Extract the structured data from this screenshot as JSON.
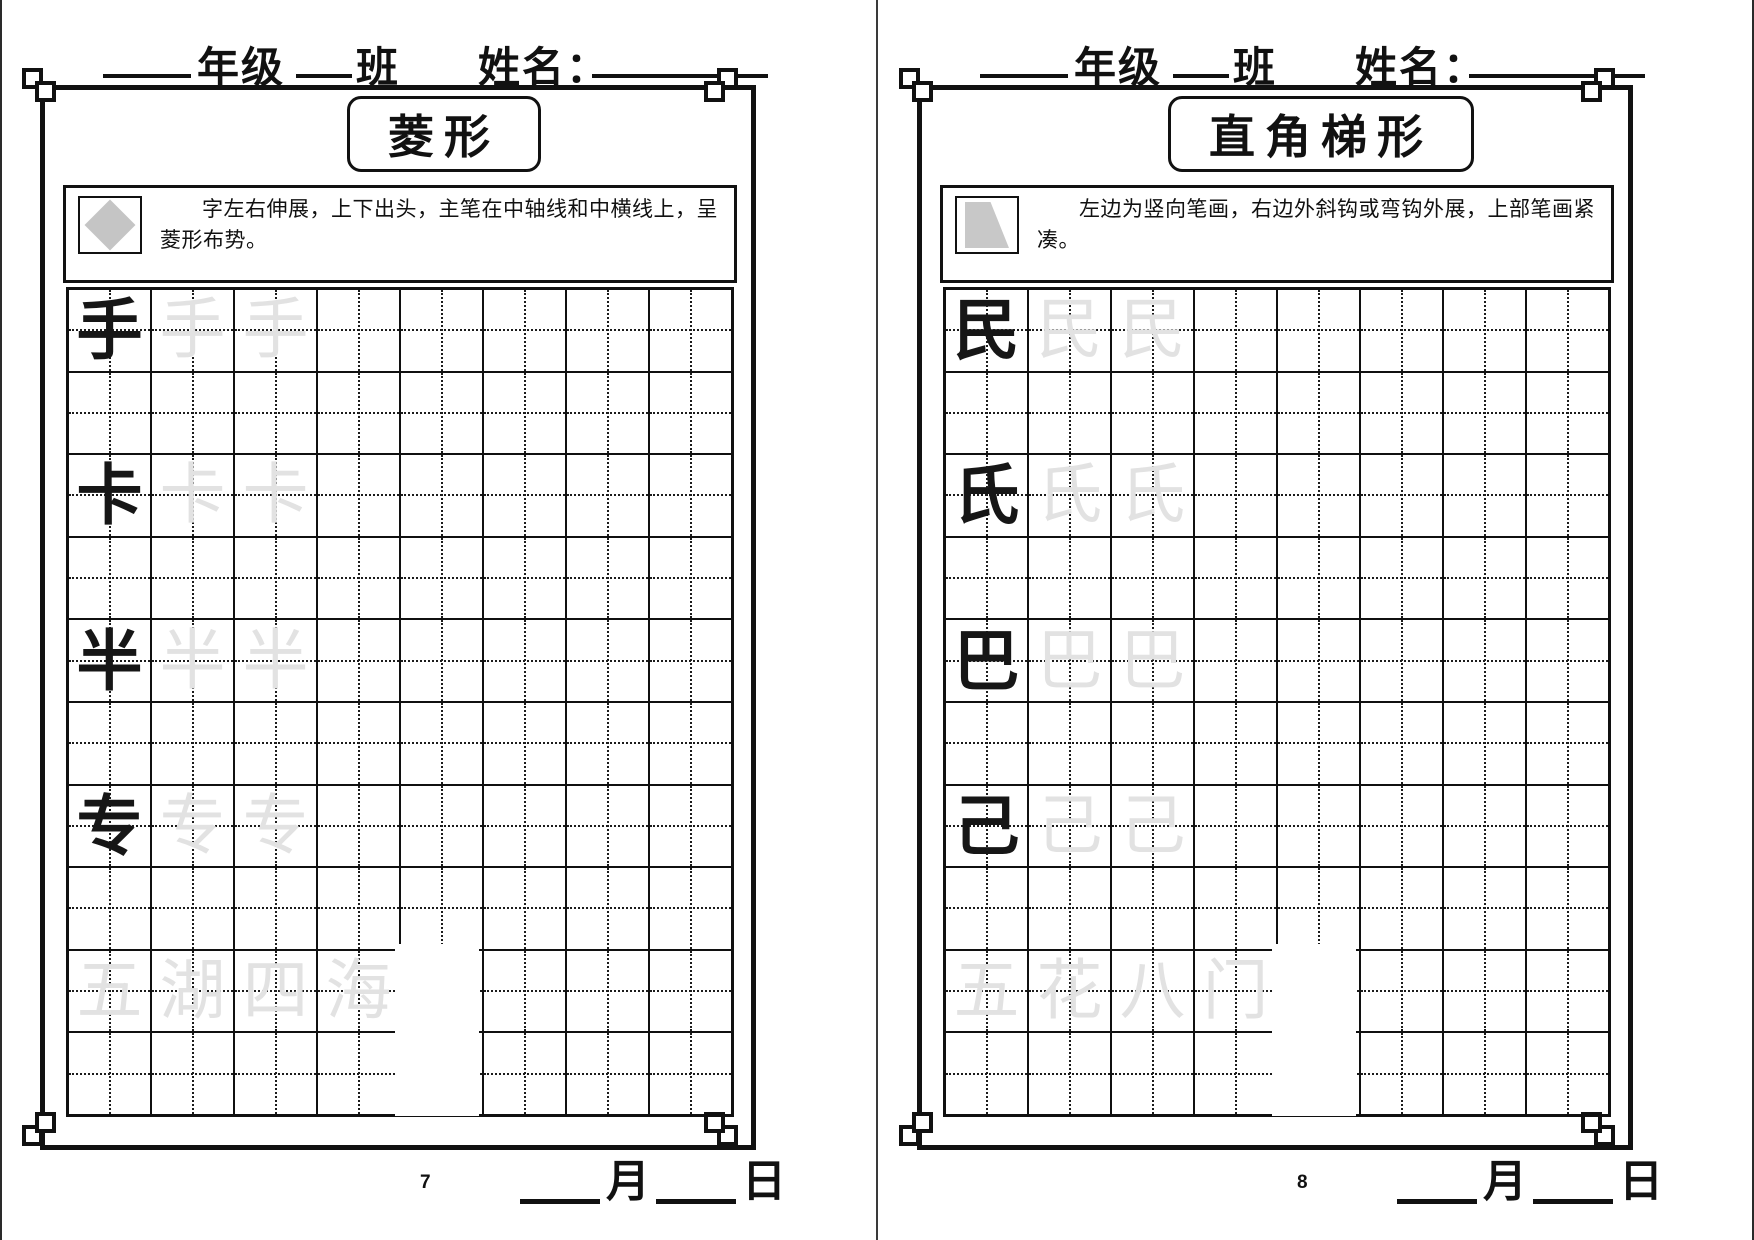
{
  "pages": [
    {
      "page_number": "7",
      "header": {
        "grade_label": "年级",
        "class_label": "班",
        "name_label": "姓名："
      },
      "title": "菱形",
      "icon": "diamond-icon",
      "instruction": "字左右伸展，上下出头，主笔在中轴线和中横线上，呈菱形布势。",
      "practice_chars": [
        "手",
        "卡",
        "半",
        "专"
      ],
      "phrase_chars": [
        "五",
        "湖",
        "四",
        "海"
      ],
      "footer": {
        "month_label": "月",
        "day_label": "日"
      }
    },
    {
      "page_number": "8",
      "header": {
        "grade_label": "年级",
        "class_label": "班",
        "name_label": "姓名："
      },
      "title": "直角梯形",
      "icon": "trapezoid-icon",
      "instruction": "左边为竖向笔画，右边外斜钩或弯钩外展，上部笔画紧凑。",
      "practice_chars": [
        "民",
        "氏",
        "巴",
        "己"
      ],
      "phrase_chars": [
        "五",
        "花",
        "八",
        "门"
      ],
      "footer": {
        "month_label": "月",
        "day_label": "日"
      }
    }
  ],
  "grid": {
    "columns": 8,
    "rows": 10,
    "char_rows": [
      0,
      2,
      4,
      6
    ],
    "phrase_row": 8,
    "ghost_copies": 2
  },
  "colors": {
    "ink": "#161616",
    "ghost": "#e2e2e2",
    "line": "#101010",
    "icon_fill": "#c5c5c5"
  }
}
